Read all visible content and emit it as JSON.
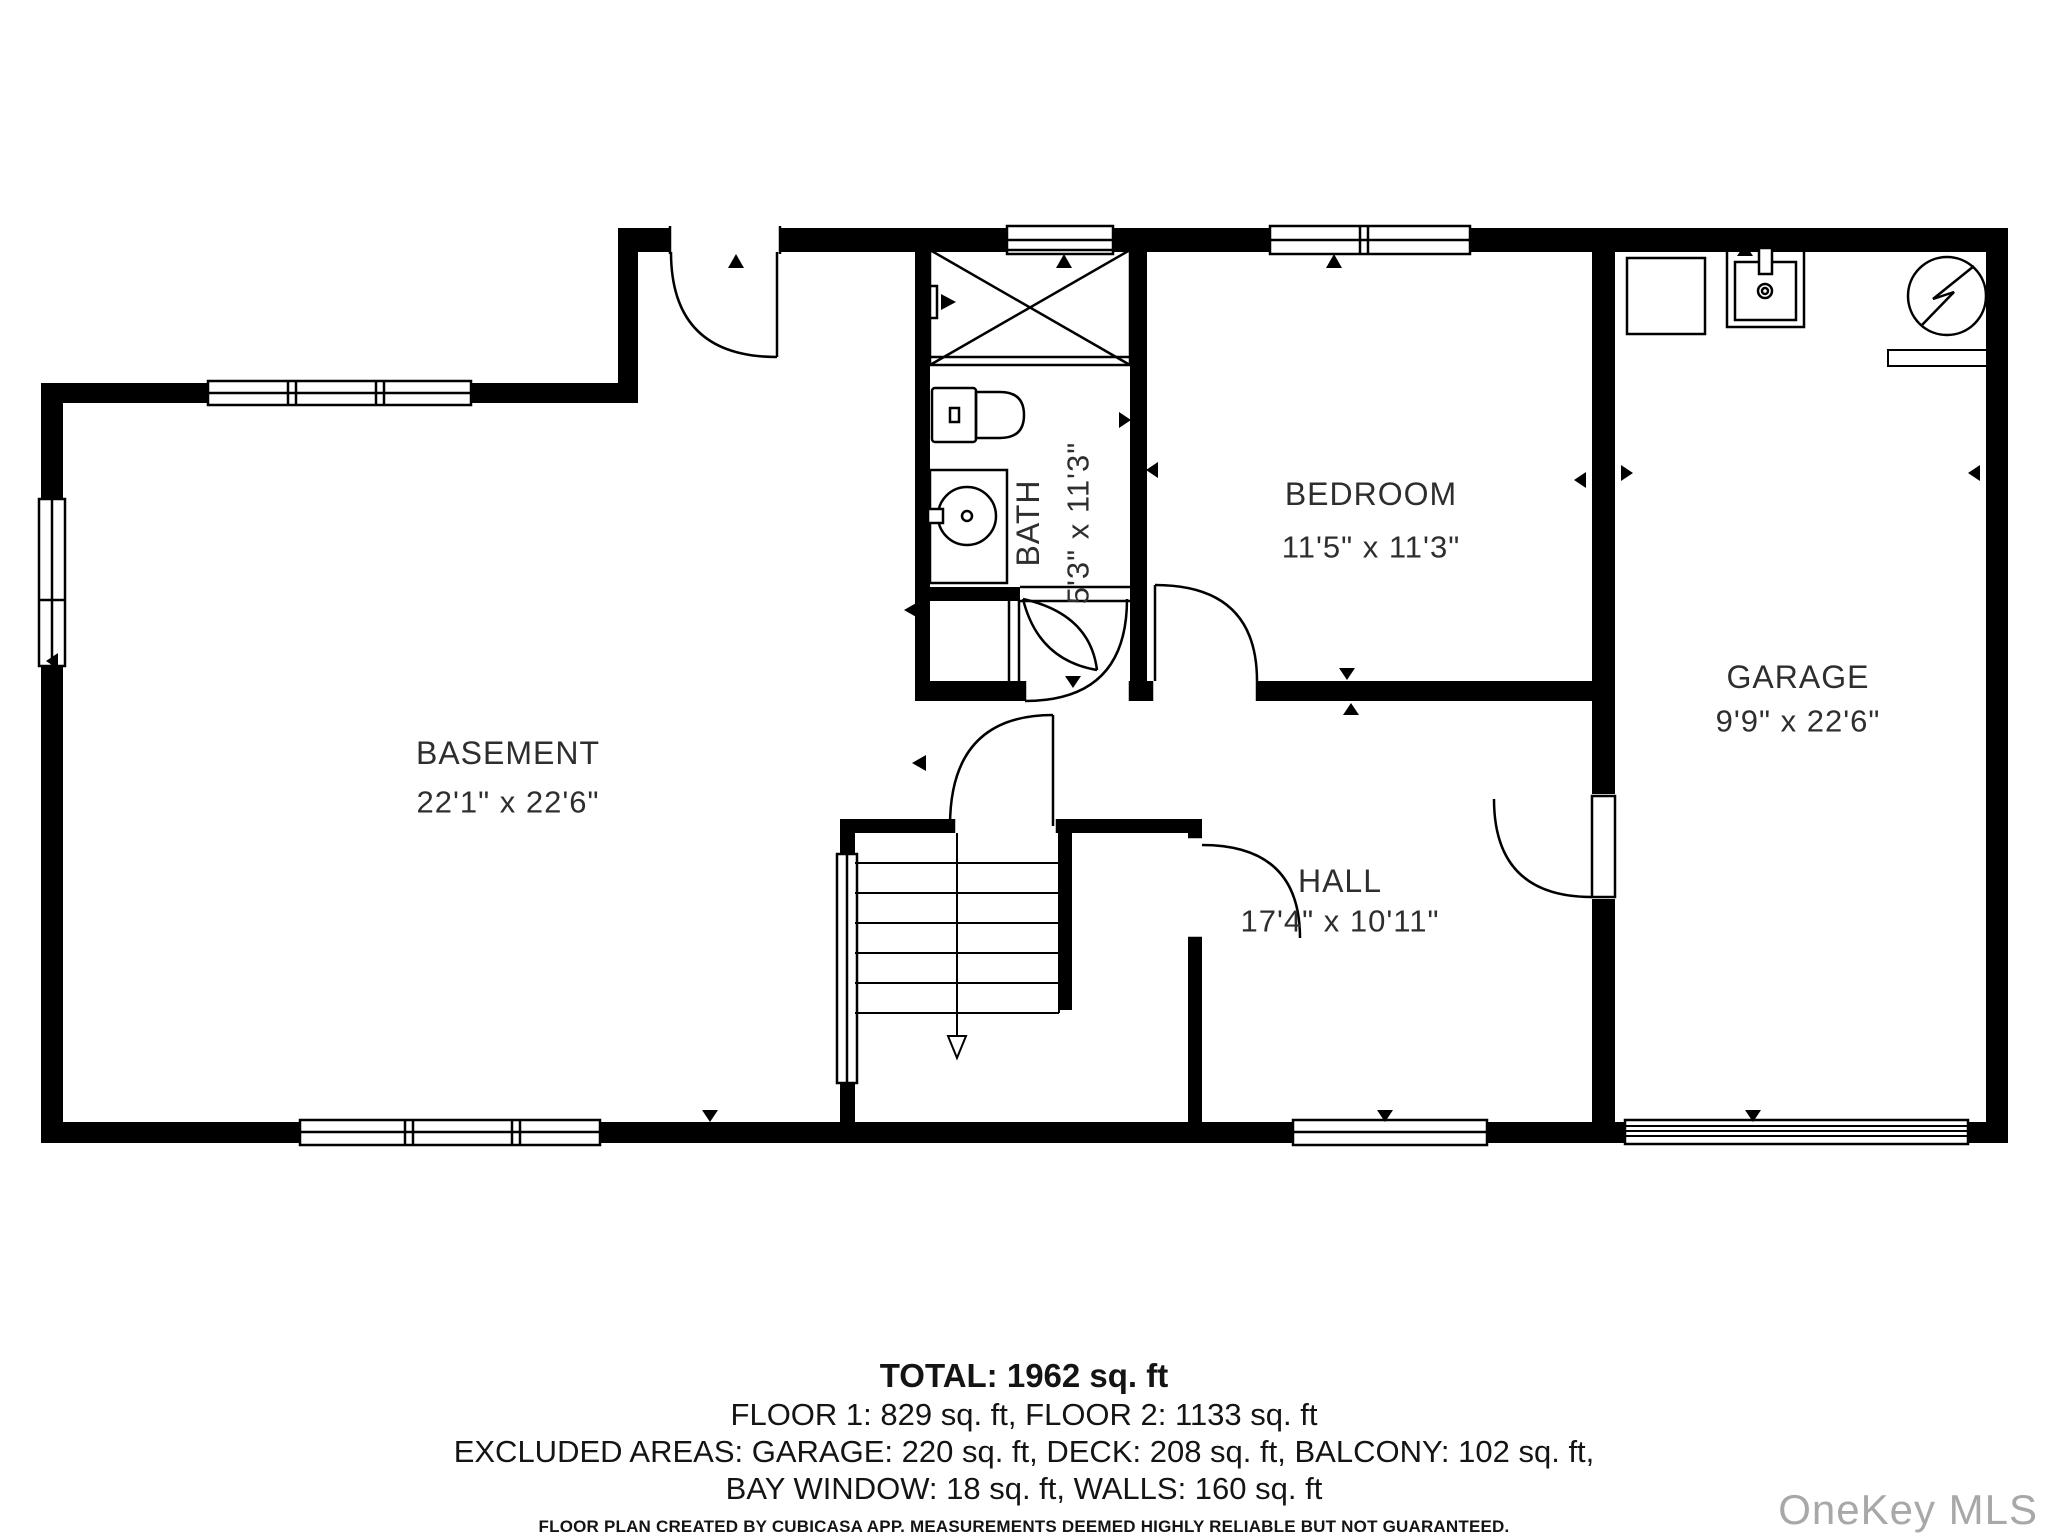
{
  "plan": {
    "rooms": {
      "basement": {
        "name": "BASEMENT",
        "dims": "22'1\" x 22'6\""
      },
      "bath": {
        "name": "BATH",
        "dims": "5'3\" x 11'3\""
      },
      "bedroom": {
        "name": "BEDROOM",
        "dims": "11'5\" x 11'3\""
      },
      "garage": {
        "name": "GARAGE",
        "dims": "9'9\" x 22'6\""
      },
      "hall": {
        "name": "HALL",
        "dims": "17'4\" x 10'11\""
      }
    },
    "icons": {
      "shower": "crossed-box",
      "toilet": "tank-and-bowl",
      "bath_sink": "round-basin-vanity",
      "garage_sink": "square-basin-faucet",
      "washer": "square-appliance",
      "electric_panel": "circle-with-bolt",
      "stairs": "treads-with-down-arrow"
    },
    "colors": {
      "wall": "#000000",
      "label": "#2e2e2e",
      "background": "#ffffff"
    }
  },
  "footer": {
    "total": "TOTAL: 1962 sq. ft",
    "floors": "FLOOR 1: 829 sq. ft, FLOOR 2: 1133 sq. ft",
    "excluded_1": "EXCLUDED AREAS: GARAGE: 220 sq. ft, DECK: 208 sq. ft, BALCONY: 102 sq. ft,",
    "excluded_2": "BAY WINDOW: 18 sq. ft, WALLS: 160 sq. ft",
    "disclaimer": "FLOOR PLAN CREATED BY CUBICASA APP. MEASUREMENTS DEEMED HIGHLY RELIABLE BUT NOT GUARANTEED."
  },
  "watermark": {
    "text": "OneKey MLS",
    "color": "#a8a8a8"
  }
}
